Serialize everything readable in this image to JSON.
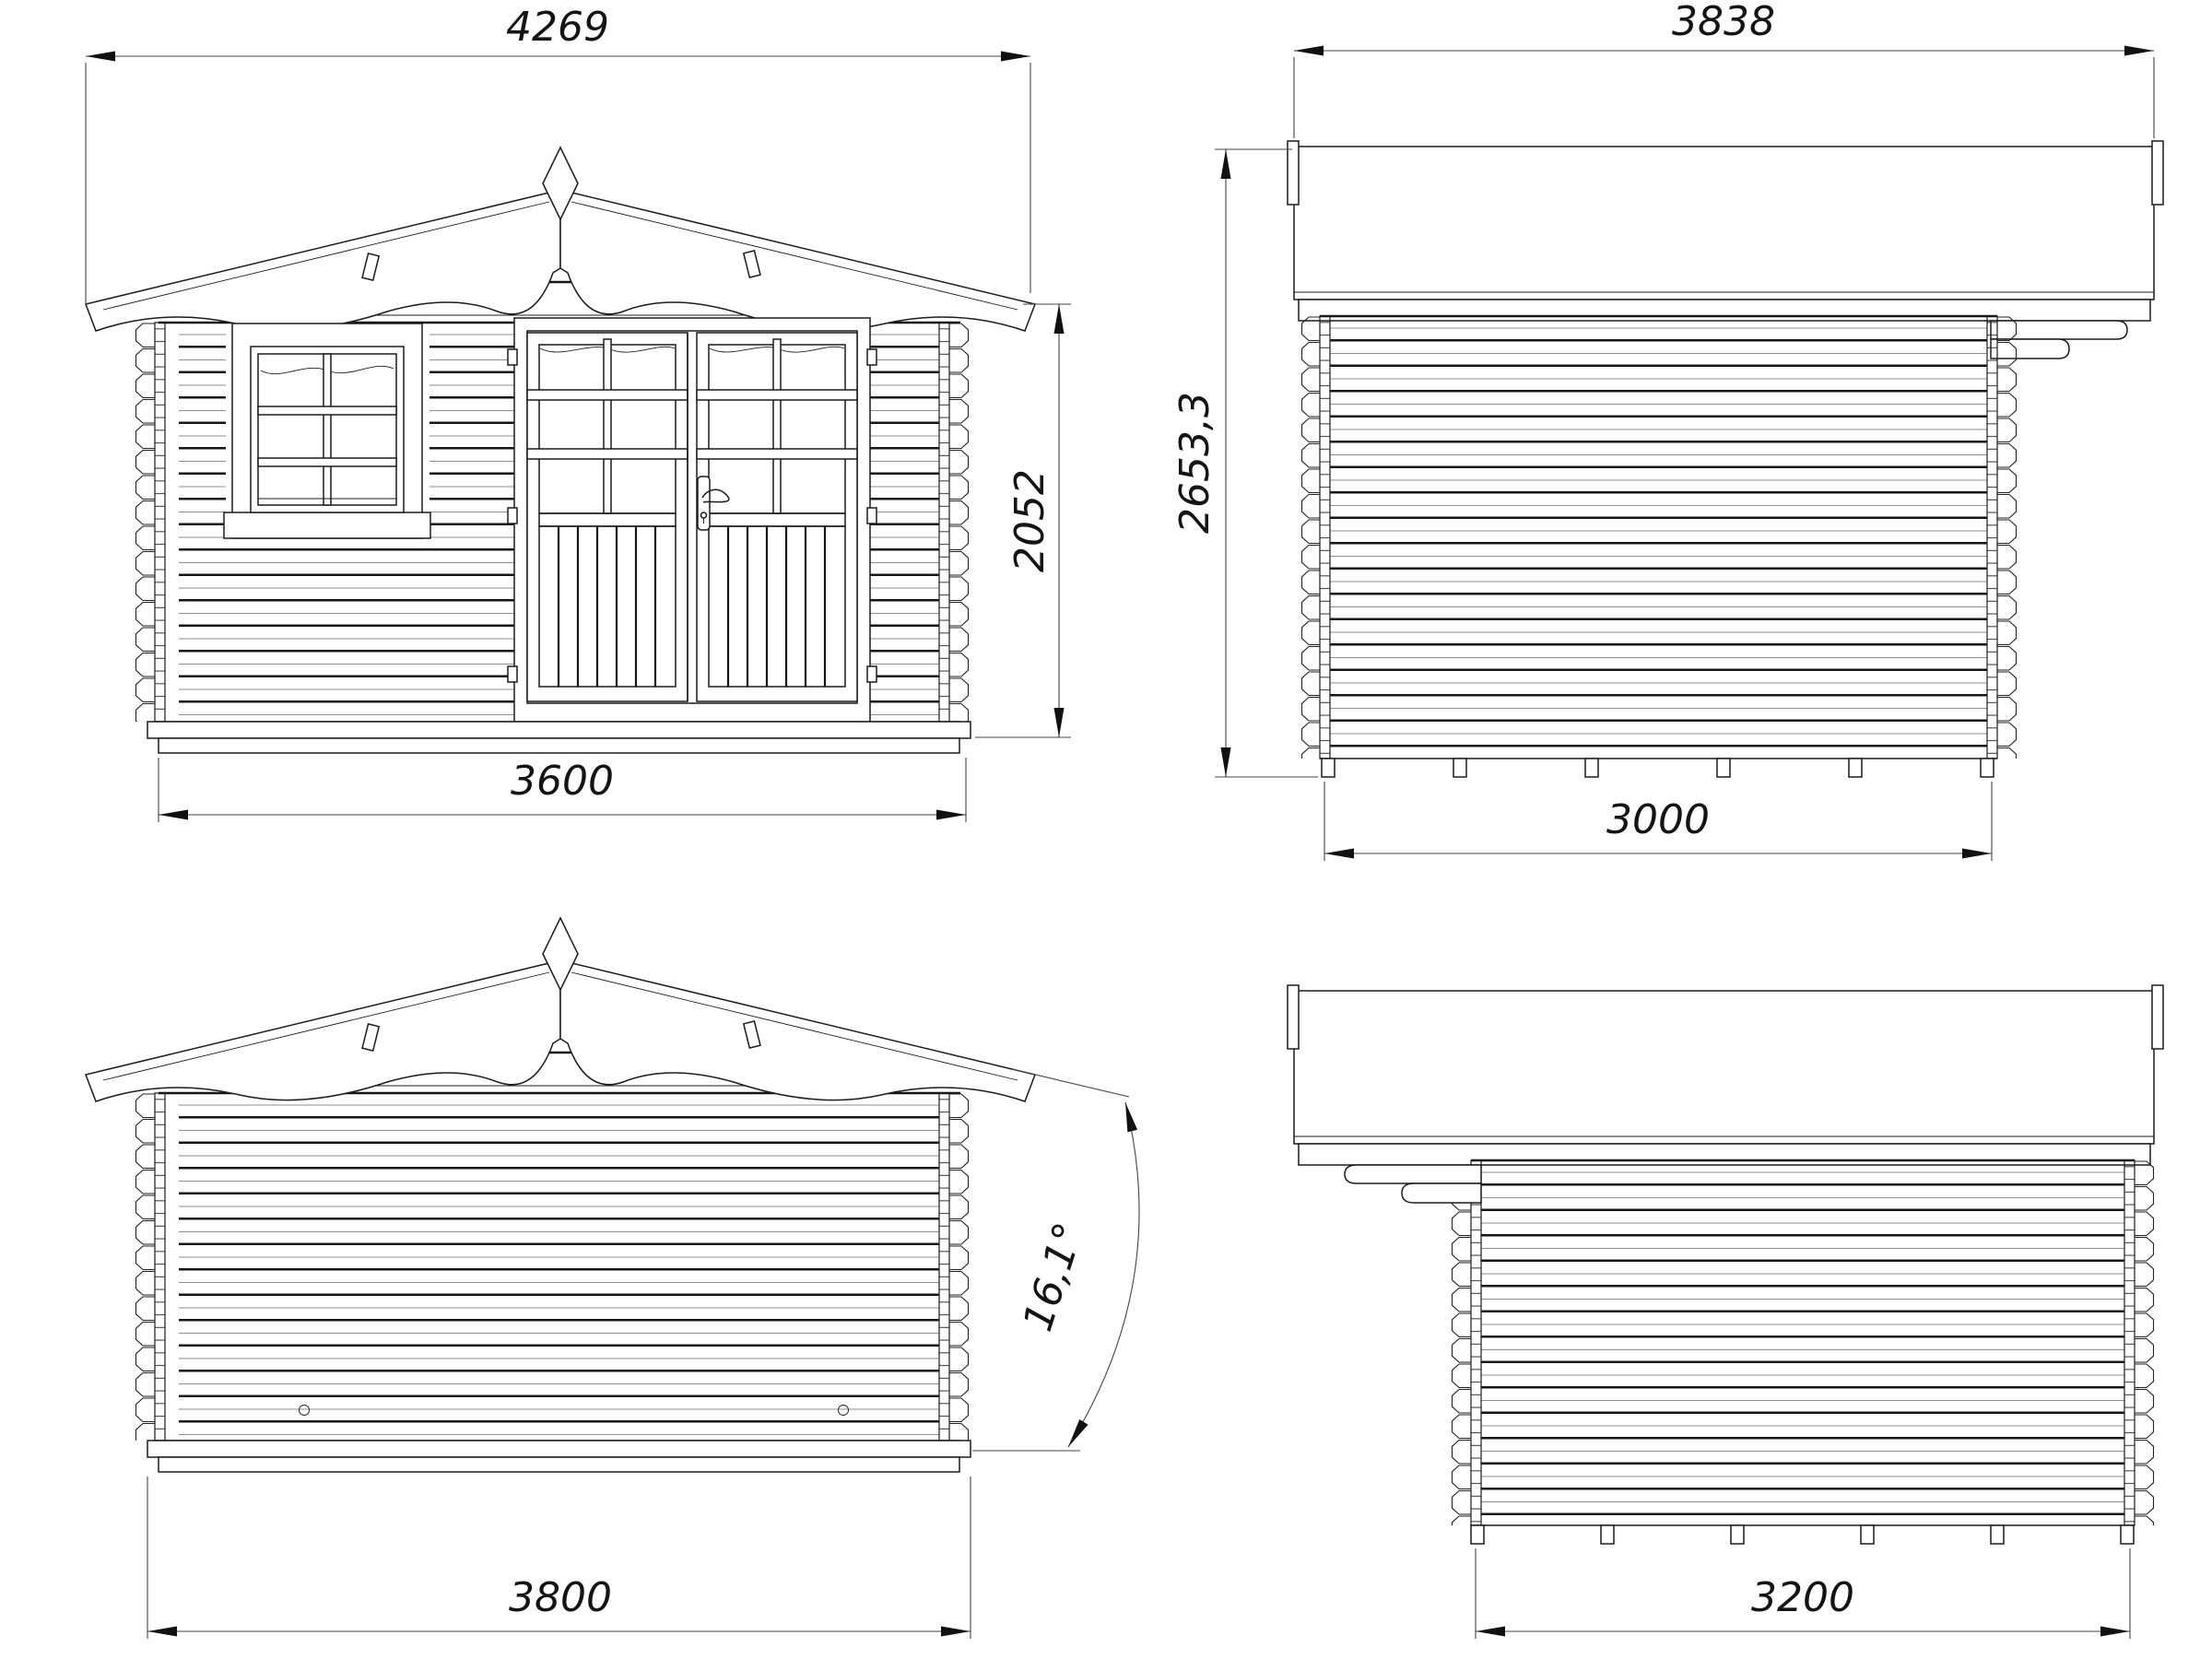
{
  "drawing": {
    "background": "#ffffff",
    "line_color": "#1a1a1a",
    "views": {
      "front": {
        "roof_width_mm": "4269",
        "eave_height_mm": "2052",
        "wall_width_mm": "3600"
      },
      "side_right": {
        "roof_width_mm": "3838",
        "total_height_mm": "2653,3",
        "wall_depth_mm": "3000"
      },
      "rear": {
        "wall_width_mm": "3800",
        "roof_pitch": "16,1°"
      },
      "side_left": {
        "wall_depth_mm": "3200"
      }
    }
  }
}
